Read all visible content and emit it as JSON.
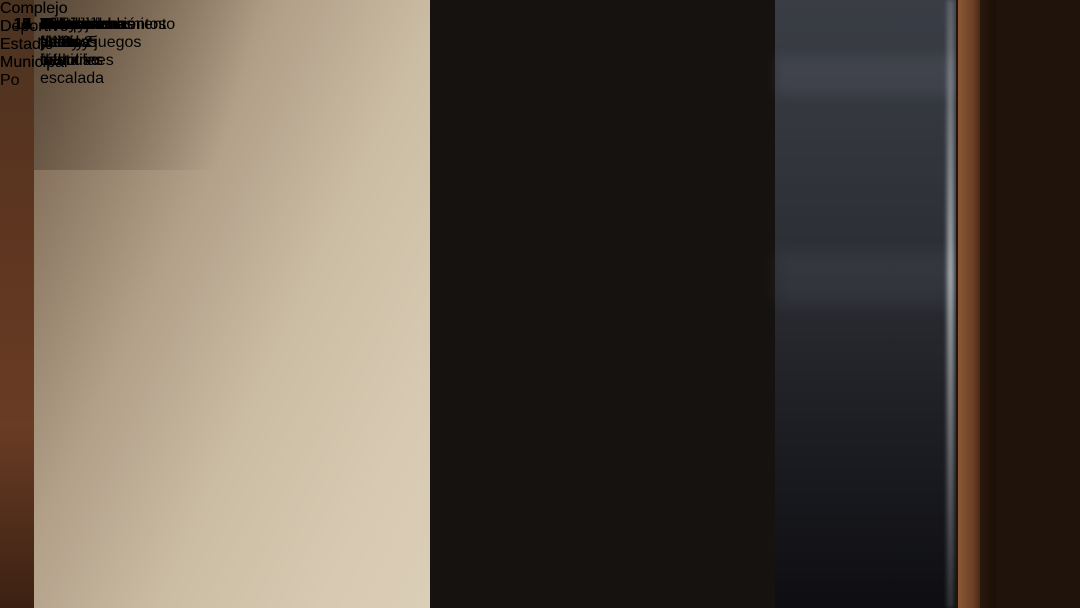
{
  "slide": {
    "header": "Complejo Deportivo Estadio Municipal",
    "caption": "Complejo Deportivo Estadio Municipal Po",
    "plan": {
      "access_label": "Acceso",
      "numbers": [
        "1",
        "2",
        "3",
        "4",
        "5",
        "6",
        "7",
        "8",
        "9",
        "10",
        "11"
      ]
    },
    "legend": {
      "bullet": "➢",
      "items": [
        {
          "num": "1.",
          "label": "Gimnasio y muros de escalada",
          "subs": []
        },
        {
          "num": "2.",
          "label": "Multicanchas N°1 y 2",
          "subs": [
            "Baby fútbol",
            "Básquetbol",
            "Voleibol"
          ]
        },
        {
          "num": "3.",
          "label": "Multicancha N° 3",
          "subs": [
            "Hokey patín",
            "Patinaje"
          ]
        },
        {
          "num": "4.",
          "label": "Multicanchas N° 4 y 5",
          "subs": [
            "Tenis",
            "Baby fútbol",
            "Voleibol"
          ]
        },
        {
          "num": "5.",
          "label": "Cancha de fútbol",
          "subs": []
        },
        {
          "num": "6.",
          "label": "Pista atlética",
          "subs": []
        },
        {
          "num": "7.",
          "label": "Skatedromo",
          "subs": []
        },
        {
          "num": "8.",
          "label": "Acondicionamiento físico y juegos infantiles",
          "subs": []
        },
        {
          "num": "9.",
          "label": "Graderías y camarines",
          "subs": []
        },
        {
          "num": "10.",
          "label": "Administración y salas multiuso",
          "subs": []
        },
        {
          "num": "11.",
          "label": "Estacionamientos",
          "subs": []
        }
      ]
    },
    "colors": {
      "legend_bg": "#d2a5c8",
      "track_red": "#da6b53",
      "pitch_green": "#3edc2b",
      "gym_square_green": "#2cdb1e",
      "skate_cyan": "#58d4c8",
      "accent_orange": "#e2662c"
    }
  }
}
